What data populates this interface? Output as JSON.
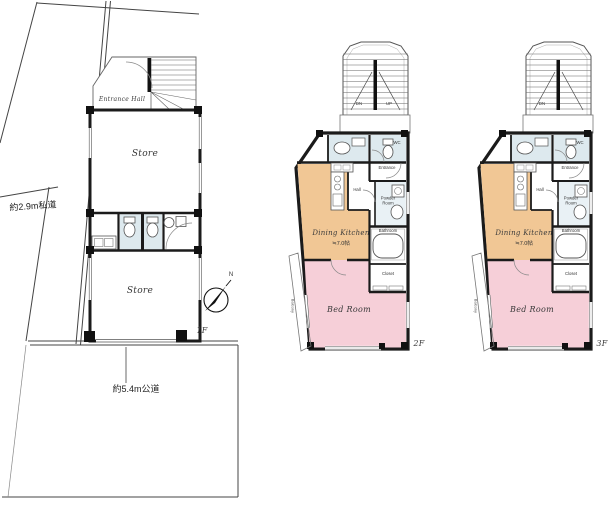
{
  "colors": {
    "dining_kitchen": "#f1c795",
    "bed_room": "#f6cfd8",
    "wet_area": "#dde9ee",
    "wall": "#1b1b1b"
  },
  "site": {
    "private_road_label": "約2.9m私道",
    "public_road_label": "約5.4m公道",
    "north_label": "N"
  },
  "floor1": {
    "floor_label": "1F",
    "entrance_hall_label": "Entrance Hall",
    "store_upper_label": "Store",
    "store_lower_label": "Store"
  },
  "floor2": {
    "floor_label": "2F",
    "stairs_down_label": "DN",
    "stairs_up_label": "UP",
    "wc_label": "WC",
    "entrance_label": "Entrance",
    "hall_label": "Hall",
    "powder_room_label": "Powder Room",
    "dining_kitchen_label": "Dining Kitchen",
    "dining_kitchen_size": "≒7.0帖",
    "bathroom_label": "Bathroom",
    "closet_label": "Closet",
    "bed_room_label": "Bed Room",
    "balcony_label": "Balcony"
  },
  "floor3": {
    "floor_label": "3F",
    "stairs_down_label": "DN",
    "wc_label": "WC",
    "entrance_label": "Entrance",
    "hall_label": "Hall",
    "powder_room_label": "Powder Room",
    "dining_kitchen_label": "Dining Kitchen",
    "dining_kitchen_size": "≒7.0帖",
    "bathroom_label": "Bathroom",
    "closet_label": "Closet",
    "bed_room_label": "Bed Room",
    "balcony_label": "Balcony"
  }
}
